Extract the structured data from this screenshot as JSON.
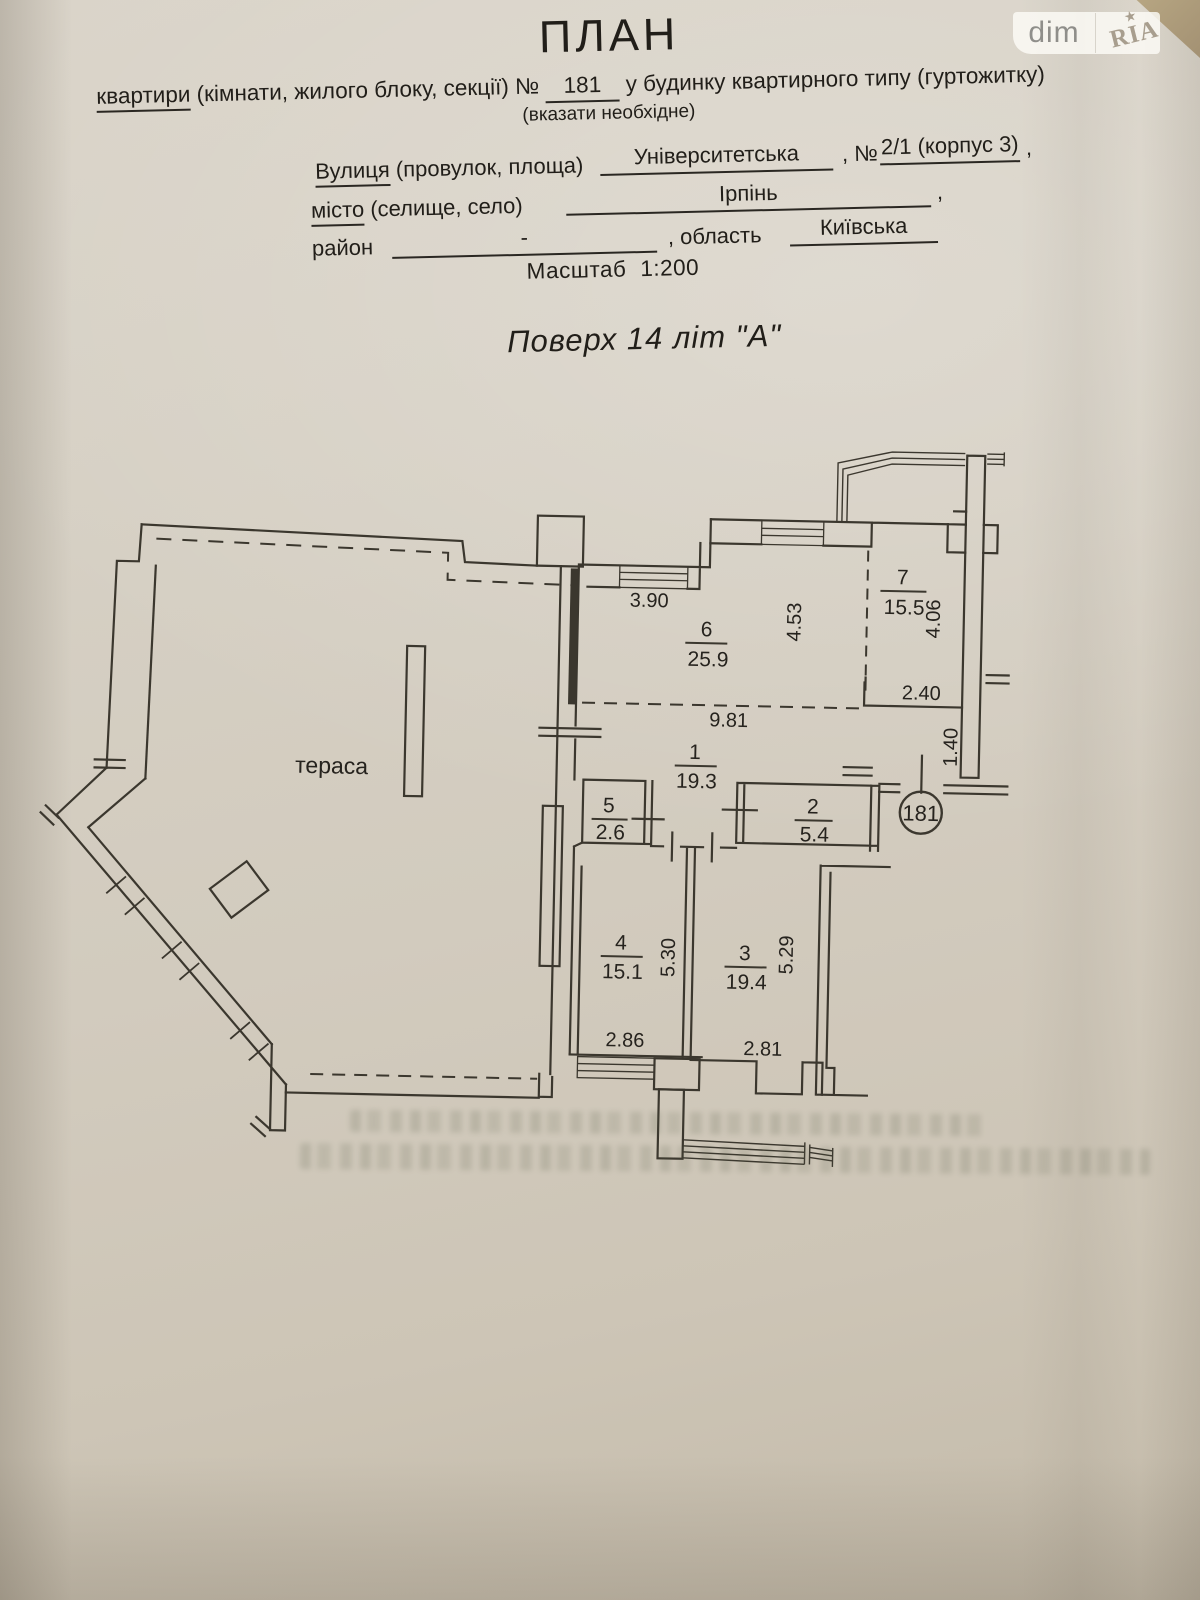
{
  "watermark": {
    "dim": "dim",
    "ria": "RIA",
    "star": "★"
  },
  "colors": {
    "paper": "#d5cec2",
    "line": "#3b372e",
    "ink": "#211e19"
  },
  "header": {
    "title": "ПЛАН",
    "line1": {
      "lead": "квартири",
      "mid": " (кімнати, жилого блоку, секції) № ",
      "num": "181",
      "tail": " у будинку квартирного типу (гуртожитку)"
    },
    "note": "(вказати необхідне)",
    "street": {
      "label_u": "Вулиця",
      "label_rest": " (провулок, площа)",
      "value": "Університетська",
      "no_label": ", №",
      "no_value": "2/1 (корпус 3)",
      "comma": ","
    },
    "city": {
      "label_u": "місто",
      "label_rest": " (селище, село)",
      "value": "Ірпінь",
      "comma": ","
    },
    "district": {
      "label": "район",
      "value": "-",
      "oblast_label": ", область",
      "oblast_value": "Київська"
    },
    "scale": {
      "label": "Масштаб",
      "value": "1:200"
    },
    "floor": {
      "text": "Поверх 14  літ \"А\""
    }
  },
  "plan": {
    "terrace_label": "тераса",
    "apartment_number": "181",
    "rooms": {
      "r1": {
        "num": "1",
        "area": "19.3"
      },
      "r2": {
        "num": "2",
        "area": "5.4"
      },
      "r3": {
        "num": "3",
        "area": "19.4"
      },
      "r4": {
        "num": "4",
        "area": "15.1"
      },
      "r5": {
        "num": "5",
        "area": "2.6"
      },
      "r6": {
        "num": "6",
        "area": "25.9"
      },
      "r7": {
        "num": "7",
        "area": "15.5"
      }
    },
    "dims": {
      "d390": "3.90",
      "d453": "4.53",
      "d406": "4.06",
      "d240": "2.40",
      "d981": "9.81",
      "d140": "1.40",
      "d530": "5.30",
      "d529": "5.29",
      "d286": "2.86",
      "d281": "2.81"
    }
  }
}
